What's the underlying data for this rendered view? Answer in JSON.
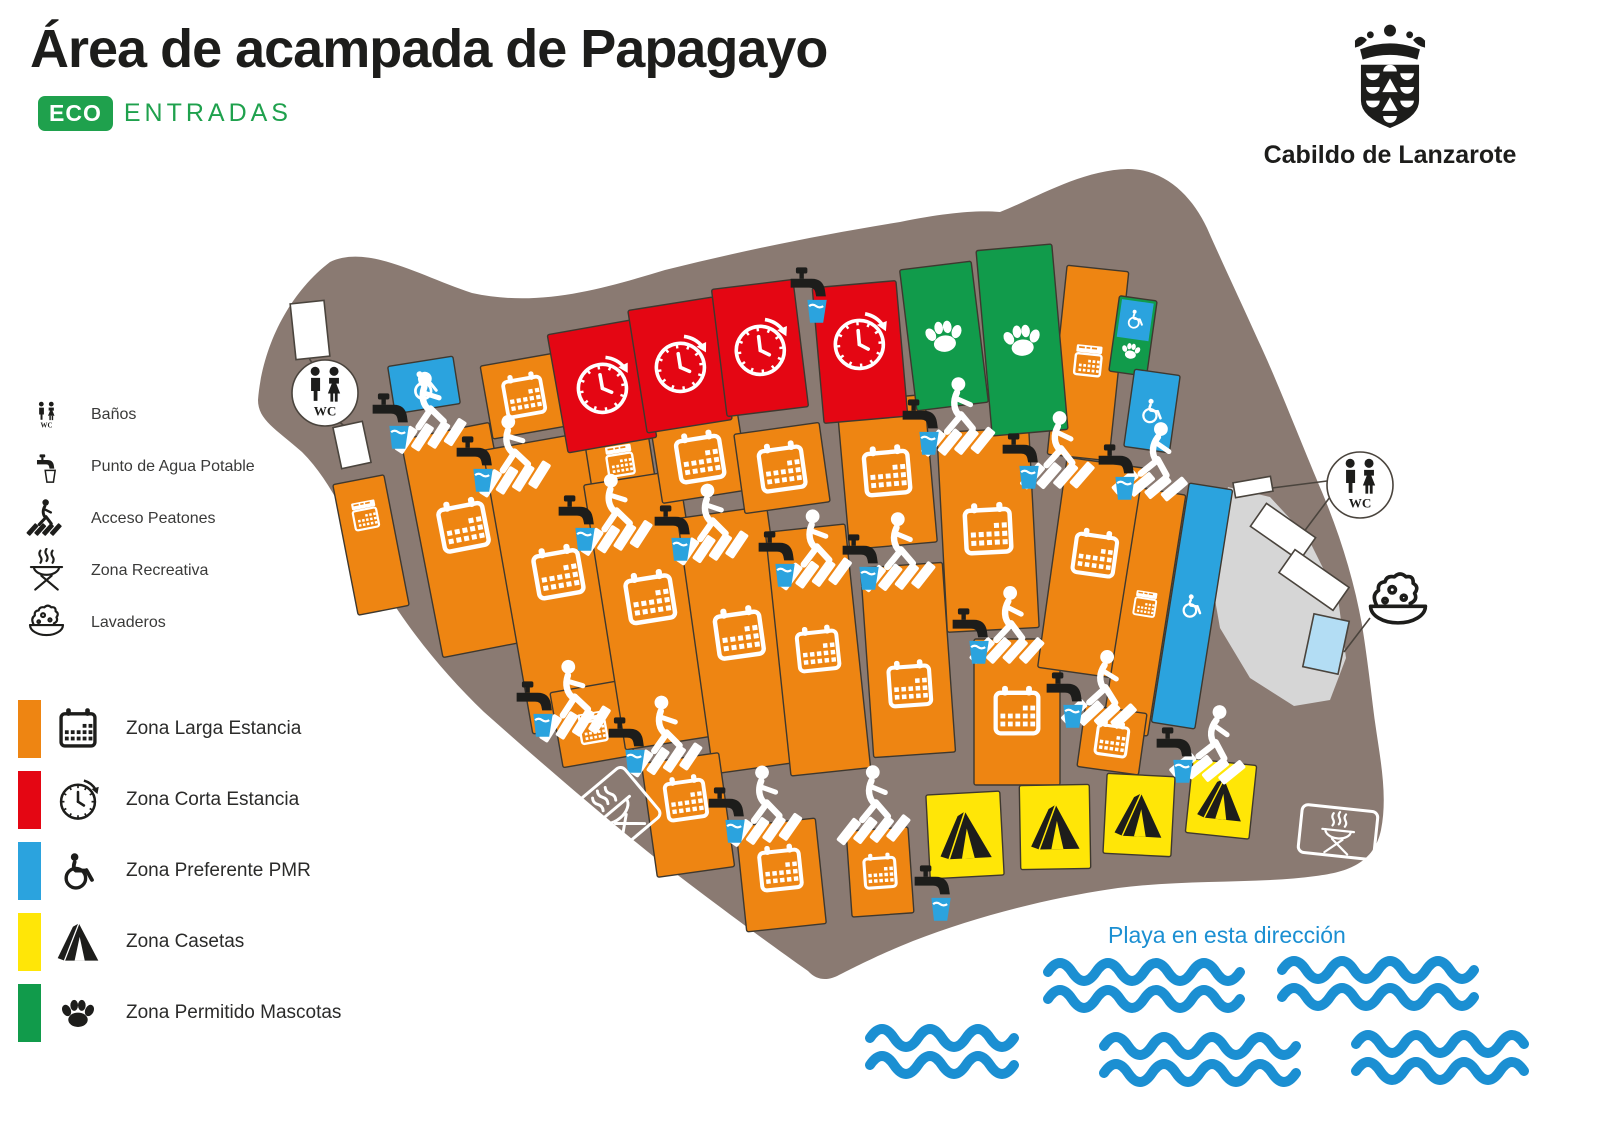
{
  "title": "Área de acampada de Papagayo",
  "eco": {
    "badge": "ECO",
    "text": "ENTRADAS",
    "green": "#1FA14D"
  },
  "cabildo": {
    "name": "Cabildo de Lanzarote"
  },
  "facility_legend": [
    {
      "icon": "wc-icon",
      "label": "Baños"
    },
    {
      "icon": "water-tap-icon",
      "label": "Punto de Agua Potable"
    },
    {
      "icon": "pedestrian-crossing-icon",
      "label": "Acceso Peatones"
    },
    {
      "icon": "bbq-icon",
      "label": "Zona Recreativa"
    },
    {
      "icon": "laundry-icon",
      "label": "Lavaderos"
    }
  ],
  "zone_legend": [
    {
      "key": "larga",
      "icon": "calendar-icon",
      "label": "Zona Larga Estancia"
    },
    {
      "key": "corta",
      "icon": "clock-icon",
      "label": "Zona Corta Estancia"
    },
    {
      "key": "pmr",
      "icon": "wheelchair-icon",
      "label": "Zona Preferente PMR"
    },
    {
      "key": "casetas",
      "icon": "tent-icon",
      "label": "Zona Casetas"
    },
    {
      "key": "mascotas",
      "icon": "paw-icon",
      "label": "Zona Permitido Mascotas"
    }
  ],
  "zone_colors": {
    "larga": "#EE8512",
    "corta": "#E40613",
    "pmr": "#2BA3DE",
    "casetas": "#FFE607",
    "mascotas": "#119B4B"
  },
  "beach": {
    "label": "Playa en esta dirección",
    "color": "#1B8FD2"
  },
  "map": {
    "ground_color": "#8A7A72",
    "rock_color": "#D6D6D6",
    "wc_label": "WC",
    "outline": "M258 400 C262 348 288 294 330 262 C368 244 420 276 472 293 C540 308 605 288 665 270 C745 250 825 234 900 222 C945 213 975 210 1000 212 C1040 196 1082 170 1128 169 C1165 169 1192 196 1207 228 C1222 262 1240 300 1258 340 C1276 378 1300 440 1322 492 C1340 535 1354 580 1362 625 C1368 662 1372 700 1375 722 C1380 758 1388 795 1381 830 C1374 863 1348 872 1316 876 C1258 884 1188 879 1118 888 C1048 898 978 916 913 941 C878 955 853 968 839 975 C830 980 818 982 808 971 C768 943 714 903 658 860 C598 812 538 760 484 712 C440 670 398 617 370 564 C348 521 330 480 302 452 C276 429 258 420 258 400 Z",
    "rock": [
      [
        1228,
        487
      ],
      [
        1270,
        497
      ],
      [
        1308,
        538
      ],
      [
        1338,
        598
      ],
      [
        1346,
        658
      ],
      [
        1330,
        700
      ],
      [
        1294,
        706
      ],
      [
        1250,
        678
      ],
      [
        1220,
        628
      ],
      [
        1208,
        560
      ]
    ],
    "zones": [
      [
        "larga",
        371,
        545,
        52,
        133,
        -11,
        "mini",
        -30
      ],
      [
        "larga",
        466,
        540,
        90,
        222,
        -11,
        "cal",
        -14
      ],
      [
        "larga",
        524,
        396,
        76,
        74,
        -10,
        "cal",
        0
      ],
      [
        "larga",
        560,
        583,
        106,
        288,
        -10,
        "cal",
        -10
      ],
      [
        "larga",
        592,
        724,
        72,
        76,
        -10,
        "mini",
        4
      ],
      [
        "larga",
        620,
        461,
        64,
        46,
        -9,
        "mini",
        0
      ],
      [
        "larga",
        652,
        610,
        96,
        268,
        -9,
        "cal",
        -12
      ],
      [
        "larga",
        700,
        458,
        88,
        78,
        -9,
        "cal",
        0
      ],
      [
        "larga",
        740,
        640,
        90,
        258,
        -8,
        "cal",
        -6
      ],
      [
        "larga",
        688,
        815,
        78,
        115,
        -8,
        "cal",
        -16
      ],
      [
        "larga",
        781,
        875,
        80,
        106,
        -6,
        "cal",
        -6
      ],
      [
        "larga",
        782,
        468,
        86,
        80,
        -8,
        "cal",
        0
      ],
      [
        "larga",
        818,
        650,
        80,
        245,
        -6,
        "cal",
        0
      ],
      [
        "larga",
        880,
        872,
        62,
        86,
        -4,
        "cal",
        0
      ],
      [
        "larga",
        887,
        472,
        88,
        148,
        -5,
        "cal",
        0
      ],
      [
        "larga",
        908,
        660,
        82,
        190,
        -4,
        "cal",
        25
      ],
      [
        "larga",
        988,
        530,
        92,
        200,
        -3,
        "cal",
        0
      ],
      [
        "larga",
        1017,
        712,
        86,
        146,
        0,
        "cal",
        0
      ],
      [
        "larga",
        1088,
        363,
        62,
        190,
        6,
        "mini",
        -2
      ],
      [
        "larga",
        1093,
        568,
        82,
        212,
        8,
        "cal",
        -14
      ],
      [
        "larga",
        1144,
        612,
        46,
        244,
        9,
        "mini",
        -8
      ],
      [
        "larga",
        1112,
        740,
        62,
        62,
        8,
        "cal",
        0
      ],
      [
        "corta",
        602,
        386,
        90,
        120,
        -10,
        "clock",
        0
      ],
      [
        "corta",
        680,
        365,
        86,
        124,
        -9,
        "clock",
        0
      ],
      [
        "corta",
        760,
        348,
        82,
        128,
        -7,
        "clock",
        0
      ],
      [
        "corta",
        860,
        352,
        84,
        136,
        -5,
        "clock",
        -10
      ],
      [
        "mascotas",
        944,
        336,
        72,
        142,
        -7,
        "paw",
        0
      ],
      [
        "mascotas",
        1022,
        340,
        76,
        186,
        -5,
        "paw",
        0
      ],
      [
        "mascotas",
        1133,
        336,
        38,
        76,
        8,
        null,
        0,
        1
      ],
      [
        "pmr",
        424,
        385,
        66,
        48,
        -9,
        "wheel",
        0
      ],
      [
        "pmr",
        1152,
        411,
        46,
        78,
        8,
        "wheel",
        0
      ],
      [
        "pmr",
        1192,
        606,
        44,
        242,
        9,
        "wheel",
        0
      ],
      [
        "casetas",
        965,
        835,
        74,
        84,
        -3,
        "tent",
        0
      ],
      [
        "casetas",
        1055,
        827,
        70,
        84,
        -1,
        "tent",
        0
      ],
      [
        "casetas",
        1139,
        815,
        68,
        80,
        3,
        "tent",
        0
      ],
      [
        "casetas",
        1221,
        799,
        64,
        74,
        6,
        "tent",
        0
      ]
    ],
    "crossings": [
      [
        432,
        412,
        -9
      ],
      [
        516,
        455,
        -10
      ],
      [
        618,
        514,
        -9
      ],
      [
        714,
        524,
        -8
      ],
      [
        818,
        550,
        -6
      ],
      [
        902,
        553,
        -4
      ],
      [
        962,
        418,
        -3
      ],
      [
        1062,
        452,
        -1
      ],
      [
        1158,
        463,
        8
      ],
      [
        576,
        700,
        -10
      ],
      [
        668,
        736,
        -8
      ],
      [
        768,
        806,
        -7
      ],
      [
        877,
        806,
        -4,
        1
      ],
      [
        1012,
        627,
        0
      ],
      [
        1106,
        691,
        5
      ],
      [
        1216,
        746,
        9
      ]
    ],
    "taps": [
      [
        810,
        292
      ],
      [
        934,
        890
      ]
    ],
    "wc_markers": [
      [
        325,
        393
      ],
      [
        1360,
        485
      ]
    ],
    "buildings": [
      [
        310,
        330,
        34,
        56,
        -6
      ],
      [
        352,
        445,
        30,
        42,
        -12
      ],
      [
        1253,
        487,
        38,
        15,
        -10
      ],
      [
        1283,
        532,
        60,
        28,
        35
      ],
      [
        1314,
        580,
        66,
        28,
        35
      ]
    ],
    "pool": {
      "x": 1326,
      "y": 644,
      "w": 36,
      "h": 54,
      "r": 12,
      "color": "#B3DDF4"
    },
    "lines": [
      [
        312,
        363,
        306,
        353
      ],
      [
        337,
        420,
        348,
        429
      ],
      [
        1327,
        481,
        1272,
        488
      ],
      [
        1330,
        497,
        1303,
        533
      ],
      [
        1370,
        618,
        1344,
        652
      ]
    ],
    "bbq_markers": [
      [
        615,
        812,
        -40,
        70,
        64
      ],
      [
        1338,
        832,
        6,
        76,
        48
      ]
    ],
    "laundry_marker": [
      1398,
      602
    ],
    "waves": [
      [
        1048,
        972,
        190
      ],
      [
        1282,
        970,
        180
      ],
      [
        870,
        1038,
        138
      ],
      [
        1104,
        1046,
        184
      ],
      [
        1356,
        1044,
        176
      ]
    ]
  }
}
